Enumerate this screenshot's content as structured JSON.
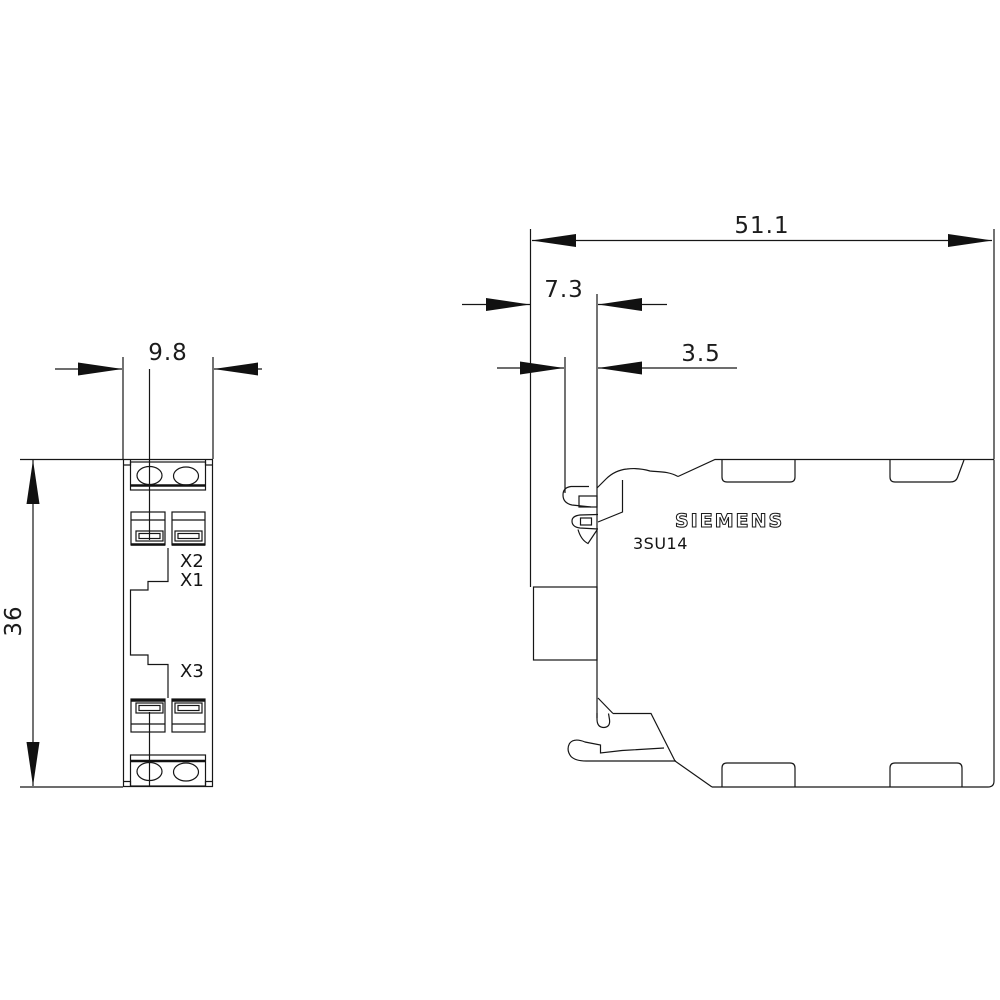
{
  "drawing": {
    "brand": "SIEMENS",
    "model": "3SU14",
    "colors": {
      "background": "#ffffff",
      "line": "#161616"
    },
    "front_view": {
      "terminals": {
        "x2": "X2",
        "x1": "X1",
        "x3": "X3"
      },
      "dimensions": {
        "width": "9.8",
        "height": "36"
      }
    },
    "side_view": {
      "markings": {
        "brand": "SIEMENS",
        "model": "3SU14"
      },
      "dimensions": {
        "total_depth": "51.1",
        "latch_depth": "7.3",
        "latch_inner_depth": "3.5"
      }
    }
  }
}
